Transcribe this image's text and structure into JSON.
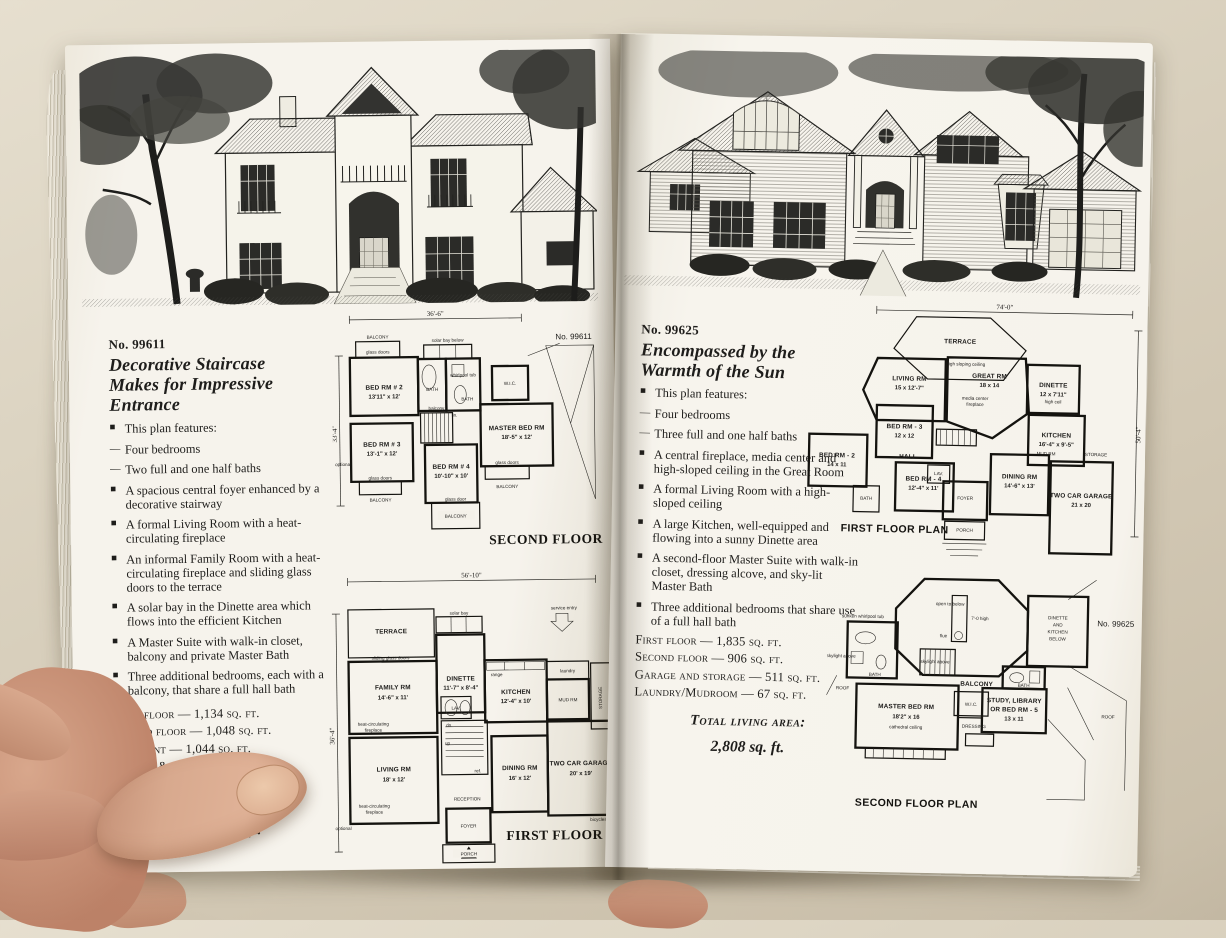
{
  "left_page": {
    "plan_no": "No. 99611",
    "title_lines": [
      "Decorative Staircase",
      "Makes for Impressive",
      "Entrance"
    ],
    "features": [
      {
        "marker": "■",
        "text": "This plan features:"
      },
      {
        "marker": "—",
        "text": "Four bedrooms"
      },
      {
        "marker": "—",
        "text": "Two full and one half baths"
      },
      {
        "marker": "■",
        "text": "A spacious central foyer enhanced by a decorative stairway"
      },
      {
        "marker": "■",
        "text": "A formal Living Room with a heat-circulating fireplace"
      },
      {
        "marker": "■",
        "text": "An informal Family Room with a heat-circulating fireplace and sliding glass doors to the terrace"
      },
      {
        "marker": "■",
        "text": "A solar bay in the Dinette area which flows into the efficient Kitchen"
      },
      {
        "marker": "■",
        "text": "A Master Suite with walk-in closet, balcony and private Master Bath"
      },
      {
        "marker": "■",
        "text": "Three additional bedrooms, each with a balcony, that share a full hall bath"
      }
    ],
    "areas": [
      "First floor — 1,134 sq. ft.",
      "Second floor — 1,048 sq. ft.",
      "Basement — 1,044 sq. ft.",
      "Garage & Storage — 475 sq. ft.",
      "Laundry/Mudroom — 80 sq. ft."
    ],
    "total_label": "Total living area:",
    "total_value": "2,262 sq. ft.",
    "second_floor": {
      "dim_top": "36'-6\"",
      "dim_left": "33'-4\"",
      "plan_no": "No. 99611",
      "balcony_tl": "BALCONY",
      "glass_doors_tl": "glass doors",
      "solar_bay": "solar bay below",
      "bed2": "BED RM # 2",
      "bed2_size": "13'11\" x 12'",
      "bath1": "BATH",
      "whirlpool": "whirlpool tub",
      "bath2": "BATH",
      "wic": "W.I.C.",
      "lin": "lin.",
      "balcony_stair": "balcony",
      "bed3": "BED RM # 3",
      "bed3_size": "13'-1\" x 12'",
      "bed4": "BED RM # 4",
      "bed4_size": "10'-10\" x 10'",
      "master": "MASTER BED RM",
      "master_size": "18'-5\" x 12'",
      "glass_doors_l": "glass doors",
      "balcony_l": "BALCONY",
      "glass_door_c": "glass door",
      "balcony_c": "BALCONY",
      "glass_doors_r": "glass doors",
      "balcony_r": "BALCONY",
      "optional": "optional",
      "floor_label": "SECOND FLOOR"
    },
    "first_floor": {
      "dim_top": "56'-10\"",
      "dim_left": "36'-4\"",
      "terrace": "TERRACE",
      "sliding_doors": "sliding glass doors",
      "solar_bay": "solar bay",
      "family": "FAMILY RM",
      "family_size": "14'-6\" x 11'",
      "dinette": "DINETTE",
      "dinette_size": "11'-7\" x 8'-4\"",
      "kitchen": "KITCHEN",
      "kitchen_size": "12'-4\" x 10'",
      "service_entry": "service entry",
      "laundry": "laundry",
      "mud_rm": "MUD RM",
      "storage": "STORAGE",
      "garage": "TWO CAR GARAGE",
      "garage_size": "20' x 19'",
      "living": "LIVING RM",
      "living_size": "18' x 12'",
      "fire1a": "heat-circulating",
      "fire1b": "fireplace",
      "fire2a": "heat-circulating",
      "fire2b": "fireplace",
      "lav": "LAV.",
      "up": "up",
      "dn": "dn.",
      "ref": "ref.",
      "range": "range",
      "dining": "DINING RM",
      "dining_size": "16' x 12'",
      "reception": "RECEPTION",
      "foyer": "FOYER",
      "porch": "PORCH",
      "bicycles": "bicycles",
      "optional": "optional",
      "floor_label": "FIRST FLOOR"
    }
  },
  "right_page": {
    "plan_no": "No. 99625",
    "title_lines": [
      "Encompassed by the",
      "Warmth of the Sun"
    ],
    "features": [
      {
        "marker": "■",
        "text": "This plan features:"
      },
      {
        "marker": "—",
        "text": "Four bedrooms"
      },
      {
        "marker": "—",
        "text": "Three full and one half baths"
      },
      {
        "marker": "■",
        "text": "A central fireplace, media center and high-sloped ceiling in the Great Room"
      },
      {
        "marker": "■",
        "text": "A formal Living Room with a high-sloped ceiling"
      },
      {
        "marker": "■",
        "text": "A large Kitchen, well-equipped and flowing into a sunny Dinette area"
      },
      {
        "marker": "■",
        "text": "A second-floor Master Suite with walk-in closet, dressing alcove, and sky-lit Master Bath"
      },
      {
        "marker": "■",
        "text": "Three additional bedrooms that share use of a full hall bath"
      }
    ],
    "areas": [
      "First floor — 1,835 sq. ft.",
      "Second floor — 906 sq. ft.",
      "Garage and storage — 511 sq. ft.",
      "Laundry/Mudroom — 67 sq. ft."
    ],
    "total_label": "Total living area:",
    "total_value": "2,808 sq. ft.",
    "first_floor": {
      "dim_top": "74'-0\"",
      "dim_right": "50'-4\"",
      "terrace": "TERRACE",
      "high_sloping": "high sloping ceiling",
      "living": "LIVING RM",
      "living_size": "15 x 12'-7\"",
      "great": "GREAT RM",
      "great_size": "18 x 14",
      "media": "media center",
      "fireplace": "fireplace",
      "dinette": "DINETTE",
      "dinette_size": "12 x 7'11\"",
      "high_ceil": "high ceil",
      "kitchen": "KITCHEN",
      "kitchen_size": "16'-4\" x 9'-5\"",
      "bed3": "BED RM - 3",
      "bed3_size": "12 x 12",
      "bed2": "BED RM - 2",
      "bed2_size": "14 x 11",
      "hall": "HALL",
      "bed4": "BED RM - 4",
      "bed4_size": "12'-4\" x 11'",
      "lav": "LAV.",
      "bath": "BATH",
      "foyer": "FOYER",
      "porch": "PORCH",
      "dining": "DINING RM",
      "dining_size": "14'-6\" x 13'",
      "garage": "TWO CAR GARAGE",
      "garage_size": "21 x 20",
      "storage": "STORAGE",
      "mud_rm": "MUD RM",
      "floor_label": "FIRST FLOOR PLAN"
    },
    "second_floor": {
      "plan_no": "No. 99625",
      "open_below": "open to below",
      "high_label": "7'-0 high",
      "flue": "flue",
      "whirlpool": "sunken whirlpool tub",
      "skylight1": "skylight above",
      "skylight2": "skylight above",
      "bath1": "BATH",
      "bath2": "BATH",
      "master": "MASTER BED RM",
      "master_size": "18'2\" x 16",
      "cathedral": "cathedral ceiling",
      "balcony": "BALCONY",
      "dressing": "DRESSING",
      "wic": "W.I.C.",
      "study_l1": "STUDY, LIBRARY",
      "study_l2": "OR BED RM - 5",
      "study_size": "13 x 11",
      "below_l1": "DINETTE",
      "below_l2": "AND",
      "below_l3": "KITCHEN",
      "below_l4": "BELOW",
      "roof1": "ROOF",
      "roof2": "ROOF",
      "floor_label": "SECOND FLOOR PLAN"
    }
  }
}
